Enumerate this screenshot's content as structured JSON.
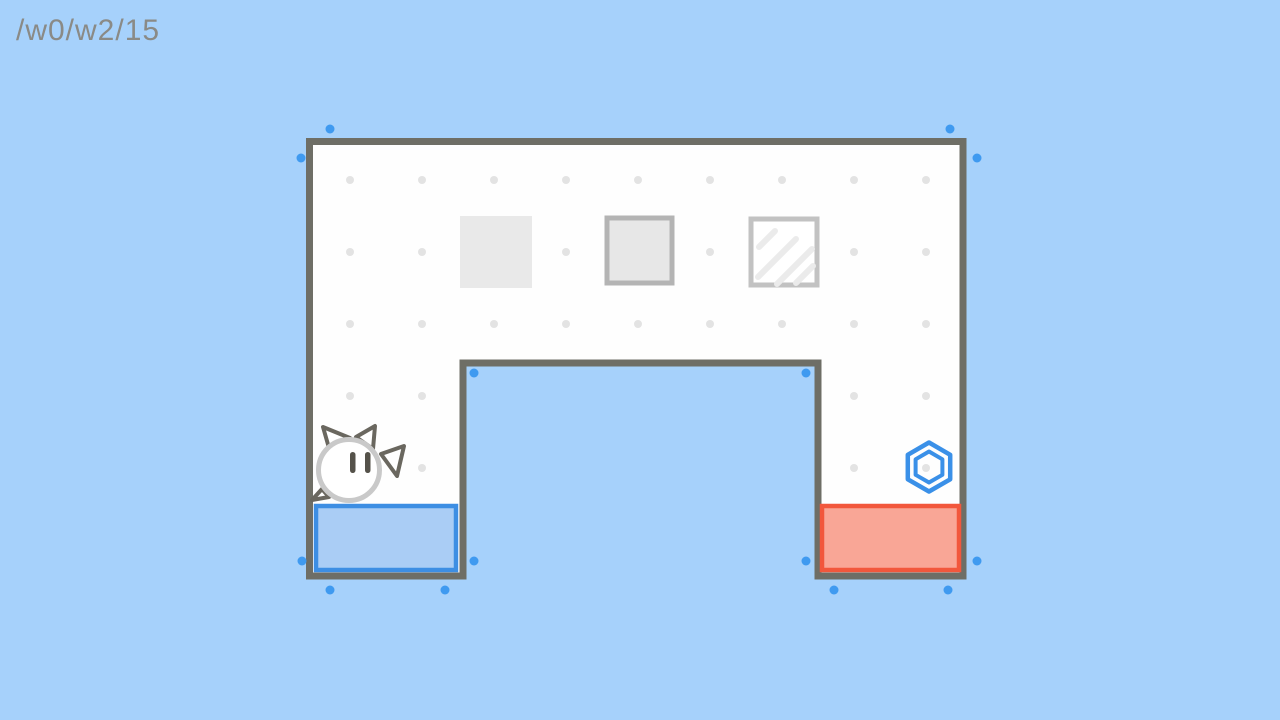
{
  "hud": {
    "level_path": "/w0/w2/15"
  },
  "colors": {
    "background": "#a6d1fb",
    "title_text": "#8a8a86",
    "wall": "#6e6e66",
    "floor": "#fefefe",
    "grid_dot": "#e3e3e3",
    "handle_dot": "#3f9af0"
  },
  "scene": {
    "walls": {
      "points": "309.5,141.5 963,141.5 963,576 818,576 818,363 463,363 463,576 309.5,576",
      "thickness": 7
    },
    "grid": {
      "cols": [
        350,
        422,
        494,
        566,
        638,
        710,
        782,
        854,
        926
      ],
      "full_rows": [
        180,
        252,
        324
      ],
      "leg_rows": [
        396,
        468
      ],
      "leg_cols": [
        350,
        422,
        854,
        926
      ],
      "radius": 4
    },
    "goals": [
      {
        "name": "goal-zone-blue",
        "x": 316,
        "y": 506,
        "w": 140,
        "h": 64,
        "border": "#3d8ee3",
        "fill": "#aacdf5",
        "sw": 4.5
      },
      {
        "name": "goal-zone-red",
        "x": 822,
        "y": 506,
        "w": 137,
        "h": 64,
        "border": "#f2573c",
        "fill": "#f9a696",
        "sw": 4.5
      }
    ],
    "blocks": [
      {
        "name": "block-solid",
        "x": 460,
        "y": 216,
        "size": 72,
        "fill": "#e9e9e9",
        "stroke": "none",
        "sw": 0
      },
      {
        "name": "block-bordered",
        "x": 607,
        "y": 218,
        "size": 65,
        "fill": "#e7e7e7",
        "stroke": "#b4b4b4",
        "sw": 5
      },
      {
        "name": "block-glass",
        "x": 751,
        "y": 219,
        "size": 66,
        "fill": "#ffffff",
        "stroke": "#c2c2c2",
        "sw": 5,
        "stripe_color": "#ebebeb",
        "stripe_w": 6,
        "stripes": [
          [
            759,
            247,
            775,
            231
          ],
          [
            758,
            277,
            796,
            239
          ],
          [
            777,
            284,
            812,
            249
          ],
          [
            796,
            283,
            813,
            266
          ]
        ]
      }
    ],
    "character": {
      "cx": 349,
      "cy": 470,
      "r": 30.5,
      "rim": "#c9c9c9",
      "rim_w": 5,
      "outline": "#6a675f",
      "outline_w": 4,
      "body_fill": "#ffffff",
      "eye_color": "#55524a",
      "ears": [
        [
          329,
          448,
          323,
          427,
          350,
          438
        ],
        [
          356,
          437,
          375,
          426,
          373,
          449
        ]
      ],
      "limbs": [
        [
          381,
          454,
          404,
          446,
          397,
          476
        ],
        [
          322,
          489,
          312,
          500,
          329,
          497
        ]
      ],
      "eyes": [
        [
          350,
          452
        ],
        [
          365,
          452
        ]
      ],
      "eye_w": 5.5,
      "eye_h": 21,
      "eye_rx": 2.7
    },
    "hexagon": {
      "cx": 929,
      "cy": 467,
      "r_outer": 24.5,
      "r_inner": 15.5,
      "color": "#3a90e8",
      "sw_outer": 4.5,
      "sw_inner": 4
    },
    "handles": {
      "radius": 4.5,
      "points": [
        [
          330,
          129
        ],
        [
          950,
          129
        ],
        [
          301,
          158
        ],
        [
          977,
          158
        ],
        [
          474,
          373
        ],
        [
          806,
          373
        ],
        [
          474,
          561
        ],
        [
          806,
          561
        ],
        [
          302,
          561
        ],
        [
          977,
          561
        ],
        [
          330,
          590
        ],
        [
          445,
          590
        ],
        [
          834,
          590
        ],
        [
          948,
          590
        ]
      ]
    }
  }
}
